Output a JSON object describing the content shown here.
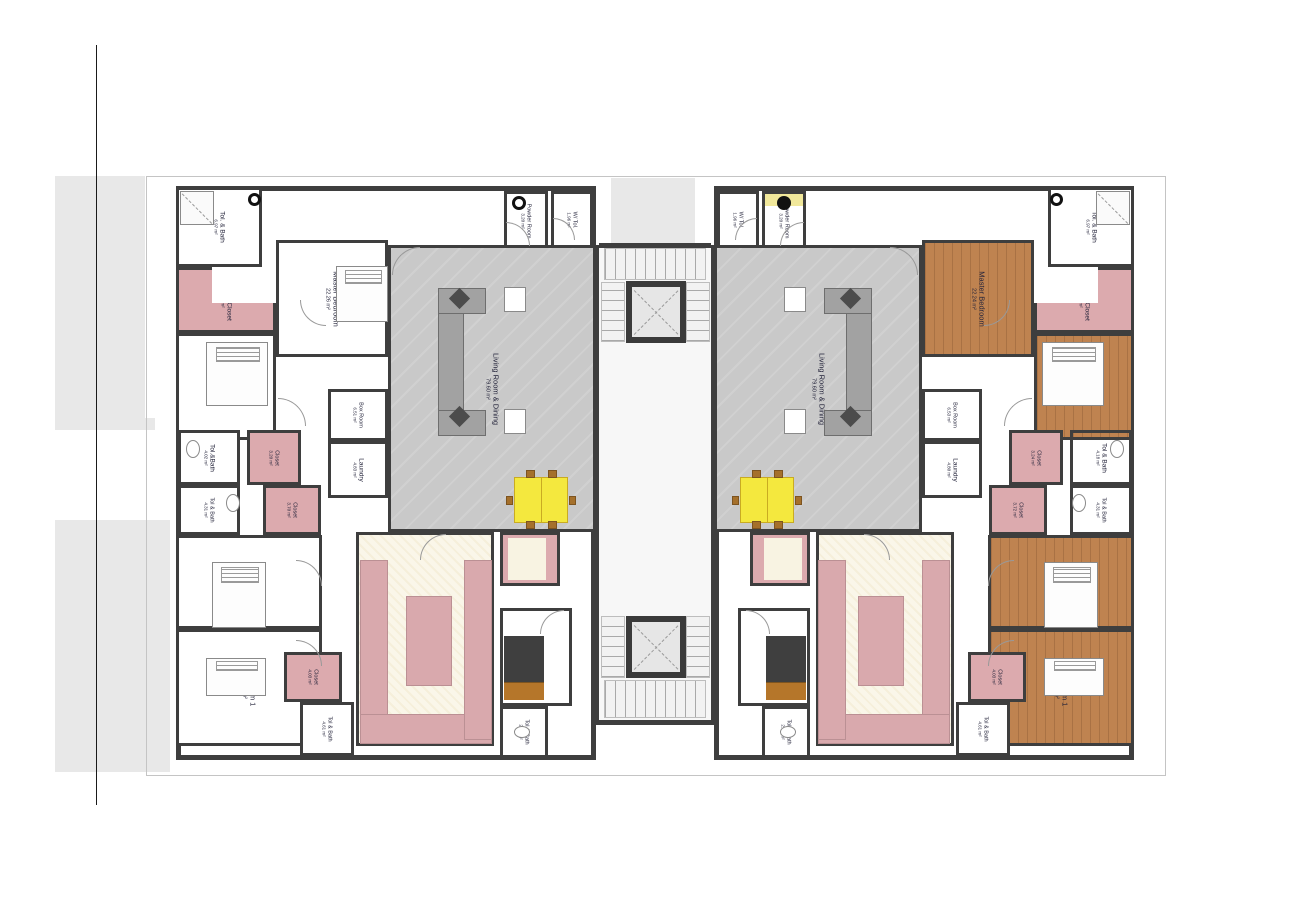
{
  "colors": {
    "wall": "#3e3e3e",
    "site_shading": "#e8e8e8",
    "pink_floor": "#dcaaae",
    "wood_floor": "#bf8350",
    "living_floor": "#c9c9c9",
    "kitchen_floor": "#faf6e9",
    "dining_table_yellow": "#f4e83e",
    "label_text": "#23233a"
  },
  "site": {
    "vertical_line": {
      "x": 96,
      "y": 45,
      "h": 760
    },
    "property_outline": {
      "x": 146,
      "y": 176,
      "w": 1018,
      "h": 598
    },
    "backdrop_blocks": [
      {
        "x": 55,
        "y": 176,
        "w": 90,
        "h": 242
      },
      {
        "x": 55,
        "y": 418,
        "w": 100,
        "h": 12
      },
      {
        "x": 55,
        "y": 520,
        "w": 115,
        "h": 252
      },
      {
        "x": 611,
        "y": 178,
        "w": 84,
        "h": 66
      }
    ]
  },
  "units": [
    {
      "id": "unit-left",
      "outline": {
        "x": 176,
        "y": 186,
        "w": 420,
        "h": 574
      },
      "rooms": [
        {
          "name": "Tol. & Bath",
          "area": "6.97 m²",
          "x": 176,
          "y": 187,
          "w": 86,
          "h": 80,
          "floor": "white"
        },
        {
          "name": "Walk-in Closet",
          "area": "8.01 m²",
          "x": 176,
          "y": 267,
          "w": 100,
          "h": 66,
          "floor": "pink"
        },
        {
          "name": "Master Bedroom",
          "area": "22.26 m²",
          "x": 276,
          "y": 240,
          "w": 112,
          "h": 117,
          "floor": "white"
        },
        {
          "name": "Bedroom 3",
          "area": "17.19 m²",
          "x": 176,
          "y": 333,
          "w": 100,
          "h": 107,
          "floor": "white"
        },
        {
          "name": "Box Room",
          "area": "6.51 m²",
          "x": 328,
          "y": 389,
          "w": 60,
          "h": 52,
          "floor": "white"
        },
        {
          "name": "Laundry",
          "area": "4.83 m²",
          "x": 328,
          "y": 441,
          "w": 60,
          "h": 57,
          "floor": "white"
        },
        {
          "name": "Tol.&Bath",
          "area": "4.02 m²",
          "x": 178,
          "y": 430,
          "w": 62,
          "h": 55,
          "floor": "white"
        },
        {
          "name": "Tol & Bath",
          "area": "4.31 m²",
          "x": 178,
          "y": 485,
          "w": 62,
          "h": 50,
          "floor": "white"
        },
        {
          "name": "Closet",
          "area": "3.20 m²",
          "x": 247,
          "y": 430,
          "w": 54,
          "h": 55,
          "floor": "pink"
        },
        {
          "name": "Closet",
          "area": "3.70 m²",
          "x": 263,
          "y": 485,
          "w": 58,
          "h": 50,
          "floor": "pink"
        },
        {
          "name": "Bedroom 2",
          "area": "18.56 m²",
          "x": 176,
          "y": 535,
          "w": 146,
          "h": 94,
          "floor": "white"
        },
        {
          "name": "Bedroom 1",
          "area": "19.80 m²",
          "x": 176,
          "y": 629,
          "w": 146,
          "h": 117,
          "floor": "white"
        },
        {
          "name": "Closet",
          "area": "4.03 m²",
          "x": 284,
          "y": 652,
          "w": 58,
          "h": 50,
          "floor": "pink"
        },
        {
          "name": "Tol & Bath",
          "area": "4.61 m²",
          "x": 300,
          "y": 702,
          "w": 54,
          "h": 54,
          "floor": "white"
        },
        {
          "name": "Kitchen",
          "area": "24.65 m²",
          "x": 356,
          "y": 532,
          "w": 138,
          "h": 214,
          "floor": "cream"
        },
        {
          "name": "Pantry",
          "area": "5.65 m²",
          "x": 500,
          "y": 532,
          "w": 60,
          "h": 54,
          "floor": "pink"
        },
        {
          "name": "B.Q.",
          "area": "13.34 m²",
          "x": 500,
          "y": 608,
          "w": 72,
          "h": 98,
          "floor": "white"
        },
        {
          "name": "Tol & Bath",
          "area": "2.53 m²",
          "x": 500,
          "y": 706,
          "w": 48,
          "h": 52,
          "floor": "white"
        },
        {
          "name": "Powder Room",
          "area": "3.20 m²",
          "x": 504,
          "y": 191,
          "w": 44,
          "h": 60,
          "floor": "white"
        },
        {
          "name": "W/ Tol.",
          "area": "1.96 m²",
          "x": 551,
          "y": 191,
          "w": 42,
          "h": 57,
          "floor": "white"
        },
        {
          "name": "Living Room & Dining",
          "area": "79.60 m²",
          "x": 388,
          "y": 245,
          "w": 208,
          "h": 287,
          "floor": "gray"
        }
      ]
    },
    {
      "id": "unit-right",
      "outline": {
        "x": 714,
        "y": 186,
        "w": 420,
        "h": 574
      },
      "rooms": [
        {
          "name": "Tol. & Bath",
          "area": "6.97 m²",
          "x": 1048,
          "y": 187,
          "w": 86,
          "h": 80,
          "floor": "white"
        },
        {
          "name": "Walk-in Closet",
          "area": "8.01 m²",
          "x": 1034,
          "y": 267,
          "w": 100,
          "h": 66,
          "floor": "pink"
        },
        {
          "name": "Master Bedroom",
          "area": "22.24 m²",
          "x": 922,
          "y": 240,
          "w": 112,
          "h": 117,
          "floor": "wood"
        },
        {
          "name": "Bedroom 3",
          "area": "17.19 m²",
          "x": 1034,
          "y": 333,
          "w": 100,
          "h": 107,
          "floor": "wood"
        },
        {
          "name": "Box Room",
          "area": "6.53 m²",
          "x": 922,
          "y": 389,
          "w": 60,
          "h": 52,
          "floor": "white"
        },
        {
          "name": "Laundry",
          "area": "4.80 m²",
          "x": 922,
          "y": 441,
          "w": 60,
          "h": 57,
          "floor": "white"
        },
        {
          "name": "Tol & Bath",
          "area": "4.18 m²",
          "x": 1070,
          "y": 430,
          "w": 62,
          "h": 55,
          "floor": "tile"
        },
        {
          "name": "Tol & Bath",
          "area": "4.31 m²",
          "x": 1070,
          "y": 485,
          "w": 62,
          "h": 50,
          "floor": "tile"
        },
        {
          "name": "Closet",
          "area": "3.24 m²",
          "x": 1009,
          "y": 430,
          "w": 54,
          "h": 55,
          "floor": "pink"
        },
        {
          "name": "Closet",
          "area": "3.72 m²",
          "x": 989,
          "y": 485,
          "w": 58,
          "h": 50,
          "floor": "pink"
        },
        {
          "name": "Bedroom 2",
          "area": "18.56 m²",
          "x": 988,
          "y": 535,
          "w": 146,
          "h": 94,
          "floor": "wood"
        },
        {
          "name": "Bedroom 1",
          "area": "19.80 m²",
          "x": 988,
          "y": 629,
          "w": 146,
          "h": 117,
          "floor": "wood"
        },
        {
          "name": "Closet",
          "area": "4.03 m²",
          "x": 968,
          "y": 652,
          "w": 58,
          "h": 50,
          "floor": "pink"
        },
        {
          "name": "Tol & Bath",
          "area": "4.61 m²",
          "x": 956,
          "y": 702,
          "w": 54,
          "h": 54,
          "floor": "white"
        },
        {
          "name": "Kitchen",
          "area": "24.65 m²",
          "x": 816,
          "y": 532,
          "w": 138,
          "h": 214,
          "floor": "cream"
        },
        {
          "name": "Pantry",
          "area": "5.65 m²",
          "x": 750,
          "y": 532,
          "w": 60,
          "h": 54,
          "floor": "pink"
        },
        {
          "name": "B.Q.",
          "area": "13.59 m²",
          "x": 738,
          "y": 608,
          "w": 72,
          "h": 98,
          "floor": "white"
        },
        {
          "name": "Tol & Bath",
          "area": "2.53 m²",
          "x": 762,
          "y": 706,
          "w": 48,
          "h": 52,
          "floor": "white"
        },
        {
          "name": "Powder Room",
          "area": "3.20 m²",
          "x": 762,
          "y": 191,
          "w": 44,
          "h": 60,
          "floor": "powder"
        },
        {
          "name": "W/ Tol.",
          "area": "1.96 m²",
          "x": 717,
          "y": 191,
          "w": 42,
          "h": 57,
          "floor": "white"
        },
        {
          "name": "Living Room & Dining",
          "area": "79.60 m²",
          "x": 714,
          "y": 245,
          "w": 208,
          "h": 287,
          "floor": "gray"
        }
      ]
    }
  ],
  "core": {
    "bg": {
      "x": 599,
      "y": 245,
      "w": 112,
      "h": 480
    },
    "walls": [
      {
        "x": 593,
        "y": 245,
        "w": 6,
        "h": 480
      },
      {
        "x": 711,
        "y": 245,
        "w": 6,
        "h": 480
      },
      {
        "x": 599,
        "y": 243,
        "w": 112,
        "h": 5
      },
      {
        "x": 599,
        "y": 720,
        "w": 112,
        "h": 5
      }
    ],
    "elevators": [
      {
        "x": 626,
        "y": 281,
        "w": 60,
        "h": 62
      },
      {
        "x": 626,
        "y": 616,
        "w": 60,
        "h": 62
      }
    ],
    "stairs": [
      {
        "x": 604,
        "y": 248,
        "w": 102,
        "h": 32,
        "dir": "v"
      },
      {
        "x": 601,
        "y": 282,
        "w": 24,
        "h": 60,
        "dir": "h"
      },
      {
        "x": 686,
        "y": 282,
        "w": 24,
        "h": 60,
        "dir": "h"
      },
      {
        "x": 601,
        "y": 616,
        "w": 24,
        "h": 62,
        "dir": "h"
      },
      {
        "x": 686,
        "y": 616,
        "w": 24,
        "h": 62,
        "dir": "h"
      },
      {
        "x": 604,
        "y": 680,
        "w": 102,
        "h": 38,
        "dir": "v"
      }
    ]
  },
  "furniture": [
    {
      "type": "sofa",
      "x": 438,
      "y": 288,
      "w": 26,
      "h": 148
    },
    {
      "type": "sofa",
      "x": 438,
      "y": 288,
      "w": 48,
      "h": 26
    },
    {
      "type": "sofa",
      "x": 438,
      "y": 410,
      "w": 48,
      "h": 26
    },
    {
      "type": "pillow",
      "x": 452,
      "y": 291,
      "w": 15,
      "h": 15
    },
    {
      "type": "pillow",
      "x": 452,
      "y": 409,
      "w": 15,
      "h": 15
    },
    {
      "type": "side-table",
      "x": 504,
      "y": 287,
      "w": 22,
      "h": 25
    },
    {
      "type": "side-table",
      "x": 504,
      "y": 409,
      "w": 22,
      "h": 25
    },
    {
      "type": "sofa",
      "x": 846,
      "y": 288,
      "w": 26,
      "h": 148
    },
    {
      "type": "sofa",
      "x": 824,
      "y": 288,
      "w": 48,
      "h": 26
    },
    {
      "type": "sofa",
      "x": 824,
      "y": 410,
      "w": 48,
      "h": 26
    },
    {
      "type": "pillow",
      "x": 843,
      "y": 291,
      "w": 15,
      "h": 15
    },
    {
      "type": "pillow",
      "x": 843,
      "y": 409,
      "w": 15,
      "h": 15
    },
    {
      "type": "side-table",
      "x": 784,
      "y": 287,
      "w": 22,
      "h": 25
    },
    {
      "type": "side-table",
      "x": 784,
      "y": 409,
      "w": 22,
      "h": 25
    },
    {
      "type": "dining-table",
      "x": 514,
      "y": 477,
      "w": 54,
      "h": 46
    },
    {
      "type": "dining-table",
      "x": 740,
      "y": 477,
      "w": 54,
      "h": 46
    },
    {
      "type": "bed",
      "x": 336,
      "y": 266,
      "w": 52,
      "h": 56
    },
    {
      "type": "bed",
      "x": 206,
      "y": 342,
      "w": 62,
      "h": 64
    },
    {
      "type": "bed",
      "x": 212,
      "y": 562,
      "w": 54,
      "h": 66
    },
    {
      "type": "bed",
      "x": 206,
      "y": 658,
      "w": 60,
      "h": 38
    },
    {
      "type": "bed",
      "x": 1042,
      "y": 342,
      "w": 62,
      "h": 64
    },
    {
      "type": "bed",
      "x": 1044,
      "y": 562,
      "w": 54,
      "h": 66
    },
    {
      "type": "bed",
      "x": 1044,
      "y": 658,
      "w": 60,
      "h": 38
    },
    {
      "type": "bq-bed",
      "x": 504,
      "y": 636,
      "w": 40,
      "h": 64
    },
    {
      "type": "bq-bed",
      "x": 766,
      "y": 636,
      "w": 40,
      "h": 64
    },
    {
      "type": "counter",
      "x": 360,
      "y": 560,
      "w": 28,
      "h": 180
    },
    {
      "type": "counter",
      "x": 360,
      "y": 714,
      "w": 132,
      "h": 30
    },
    {
      "type": "counter",
      "x": 464,
      "y": 560,
      "w": 28,
      "h": 180
    },
    {
      "type": "counter",
      "x": 406,
      "y": 596,
      "w": 46,
      "h": 90
    },
    {
      "type": "counter",
      "x": 922,
      "y": 560,
      "w": 28,
      "h": 180
    },
    {
      "type": "counter",
      "x": 818,
      "y": 714,
      "w": 132,
      "h": 30
    },
    {
      "type": "counter",
      "x": 818,
      "y": 560,
      "w": 28,
      "h": 180
    },
    {
      "type": "counter",
      "x": 858,
      "y": 596,
      "w": 46,
      "h": 90
    },
    {
      "type": "closet-shelf",
      "x": 212,
      "y": 267,
      "w": 64,
      "h": 36
    },
    {
      "type": "closet-shelf",
      "x": 1034,
      "y": 267,
      "w": 64,
      "h": 36
    },
    {
      "type": "pantry-shelf",
      "x": 508,
      "y": 538,
      "w": 38,
      "h": 42
    },
    {
      "type": "pantry-shelf",
      "x": 764,
      "y": 538,
      "w": 38,
      "h": 42
    },
    {
      "type": "sink-ring",
      "x": 512,
      "y": 196,
      "w": 14,
      "h": 14
    },
    {
      "type": "sink-dot",
      "x": 777,
      "y": 196,
      "w": 14,
      "h": 14
    },
    {
      "type": "shower",
      "x": 180,
      "y": 191,
      "w": 34,
      "h": 34
    },
    {
      "type": "shower",
      "x": 1096,
      "y": 191,
      "w": 34,
      "h": 34
    },
    {
      "type": "toilet-ring",
      "x": 248,
      "y": 193,
      "w": 13,
      "h": 13
    },
    {
      "type": "toilet-ring",
      "x": 1050,
      "y": 193,
      "w": 13,
      "h": 13
    },
    {
      "type": "toilet",
      "x": 186,
      "y": 440,
      "w": 14,
      "h": 18
    },
    {
      "type": "toilet",
      "x": 226,
      "y": 494,
      "w": 14,
      "h": 18
    },
    {
      "type": "toilet",
      "x": 1110,
      "y": 440,
      "w": 14,
      "h": 18
    },
    {
      "type": "toilet",
      "x": 1072,
      "y": 494,
      "w": 14,
      "h": 18
    },
    {
      "type": "toilet",
      "x": 514,
      "y": 726,
      "w": 16,
      "h": 12
    },
    {
      "type": "toilet",
      "x": 780,
      "y": 726,
      "w": 16,
      "h": 12
    }
  ],
  "doors": [
    {
      "x": 506,
      "y": 222,
      "r": 24,
      "c": "tr"
    },
    {
      "x": 553,
      "y": 218,
      "r": 22,
      "c": "tr"
    },
    {
      "x": 300,
      "y": 300,
      "r": 26,
      "c": "bl"
    },
    {
      "x": 278,
      "y": 398,
      "r": 28,
      "c": "tr"
    },
    {
      "x": 296,
      "y": 560,
      "r": 26,
      "c": "tr"
    },
    {
      "x": 296,
      "y": 640,
      "r": 26,
      "c": "tr"
    },
    {
      "x": 420,
      "y": 534,
      "r": 26,
      "c": "tl"
    },
    {
      "x": 540,
      "y": 610,
      "r": 24,
      "c": "tl"
    },
    {
      "x": 392,
      "y": 247,
      "r": 28,
      "c": "tl"
    },
    {
      "x": 780,
      "y": 222,
      "r": 24,
      "c": "tl"
    },
    {
      "x": 735,
      "y": 218,
      "r": 22,
      "c": "tl"
    },
    {
      "x": 984,
      "y": 300,
      "r": 26,
      "c": "br"
    },
    {
      "x": 1004,
      "y": 398,
      "r": 28,
      "c": "tl"
    },
    {
      "x": 988,
      "y": 560,
      "r": 26,
      "c": "tl"
    },
    {
      "x": 988,
      "y": 640,
      "r": 26,
      "c": "tl"
    },
    {
      "x": 864,
      "y": 534,
      "r": 26,
      "c": "tr"
    },
    {
      "x": 746,
      "y": 610,
      "r": 24,
      "c": "tr"
    },
    {
      "x": 890,
      "y": 247,
      "r": 28,
      "c": "tr"
    }
  ]
}
